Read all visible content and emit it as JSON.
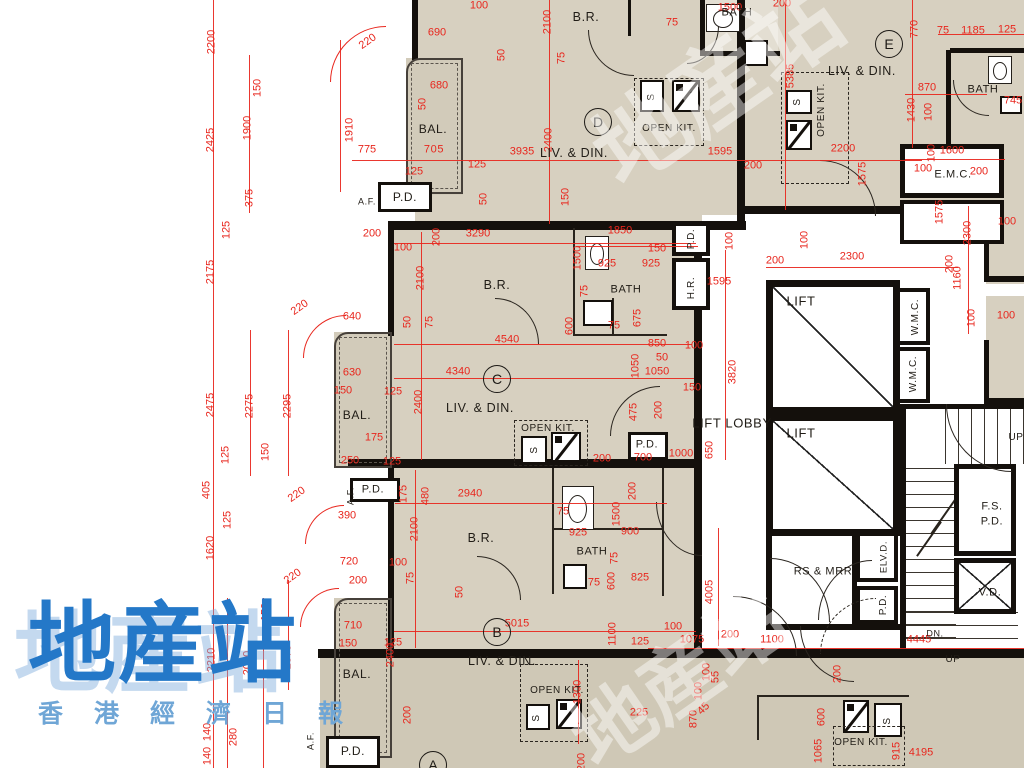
{
  "title": "residential floor plan",
  "colors": {
    "dim_red": "#e8261d",
    "wall": "#14100c",
    "room_fill": "#d7d0c0",
    "balcony_fill": "#d2cbba",
    "watermark_blue": "#2478c8",
    "watermark_sub": "#6fa6d6"
  },
  "watermark": {
    "main": "地産站",
    "sub": "香港經濟日報",
    "faint": "地産站"
  },
  "unit_circles": [
    {
      "t": "D",
      "x": 598,
      "y": 122
    },
    {
      "t": "E",
      "x": 889,
      "y": 44
    },
    {
      "t": "C",
      "x": 497,
      "y": 379
    },
    {
      "t": "B",
      "x": 497,
      "y": 632
    },
    {
      "t": "A",
      "x": 433,
      "y": 765
    }
  ],
  "room_labels": [
    {
      "t": "B.R.",
      "x": 586,
      "y": 17
    },
    {
      "t": "BATH",
      "x": 737,
      "y": 13,
      "s": 11
    },
    {
      "t": "BAL.",
      "x": 433,
      "y": 129,
      "s": 12
    },
    {
      "t": "705",
      "x": 434,
      "y": 150,
      "s": 11,
      "red": 1
    },
    {
      "t": "LIV. & DIN.",
      "x": 574,
      "y": 153
    },
    {
      "t": "OPEN KIT.",
      "x": 669,
      "y": 129,
      "s": 10
    },
    {
      "t": "P.D.",
      "x": 405,
      "y": 197,
      "s": 12
    },
    {
      "t": "A.F.",
      "x": 367,
      "y": 202,
      "s": 9
    },
    {
      "t": "LIV. & DIN.",
      "x": 862,
      "y": 71
    },
    {
      "t": "OPEN KIT.",
      "x": 822,
      "y": 110,
      "s": 10,
      "v": 1
    },
    {
      "t": "BATH",
      "x": 983,
      "y": 90,
      "s": 11
    },
    {
      "t": "E.M.C.",
      "x": 953,
      "y": 175,
      "s": 11
    },
    {
      "t": "B.R.",
      "x": 497,
      "y": 285
    },
    {
      "t": "BATH",
      "x": 626,
      "y": 290,
      "s": 11
    },
    {
      "t": "LIV. & DIN.",
      "x": 480,
      "y": 408
    },
    {
      "t": "OPEN KIT.",
      "x": 548,
      "y": 429,
      "s": 10
    },
    {
      "t": "BAL.",
      "x": 357,
      "y": 415,
      "s": 12
    },
    {
      "t": "P.D.",
      "x": 692,
      "y": 239,
      "s": 10,
      "v": 1
    },
    {
      "t": "H.R.",
      "x": 692,
      "y": 288,
      "s": 10,
      "v": 1
    },
    {
      "t": "P.D.",
      "x": 373,
      "y": 490,
      "s": 11
    },
    {
      "t": "A.F.",
      "x": 351,
      "y": 496,
      "s": 9,
      "v": 1
    },
    {
      "t": "LIFT",
      "x": 801,
      "y": 301,
      "s": 13
    },
    {
      "t": "LIFT",
      "x": 801,
      "y": 433,
      "s": 13
    },
    {
      "t": "LIFT LOBBY",
      "x": 732,
      "y": 423,
      "s": 13
    },
    {
      "t": "W.M.C.",
      "x": 916,
      "y": 317,
      "s": 10,
      "v": 1
    },
    {
      "t": "W.M.C.",
      "x": 914,
      "y": 374,
      "s": 10,
      "v": 1
    },
    {
      "t": "P.D.",
      "x": 647,
      "y": 445,
      "s": 11
    },
    {
      "t": "B.R.",
      "x": 481,
      "y": 538
    },
    {
      "t": "BATH",
      "x": 592,
      "y": 552,
      "s": 11
    },
    {
      "t": "LIV. & DIN.",
      "x": 502,
      "y": 661
    },
    {
      "t": "OPEN KIT.",
      "x": 557,
      "y": 691,
      "s": 10
    },
    {
      "t": "BAL.",
      "x": 357,
      "y": 674,
      "s": 12
    },
    {
      "t": "P.D.",
      "x": 353,
      "y": 751,
      "s": 12
    },
    {
      "t": "A.F.",
      "x": 311,
      "y": 741,
      "s": 9,
      "v": 1
    },
    {
      "t": "RS & MRR",
      "x": 823,
      "y": 572,
      "s": 11
    },
    {
      "t": "ELV.D.",
      "x": 884,
      "y": 557,
      "s": 9.5,
      "v": 1
    },
    {
      "t": "P.D.",
      "x": 884,
      "y": 605,
      "s": 10,
      "v": 1
    },
    {
      "t": "F.S.",
      "x": 992,
      "y": 507,
      "s": 11
    },
    {
      "t": "P.D.",
      "x": 992,
      "y": 522,
      "s": 11
    },
    {
      "t": "V.D.",
      "x": 990,
      "y": 593,
      "s": 11
    },
    {
      "t": "DN.",
      "x": 935,
      "y": 634,
      "s": 9
    },
    {
      "t": "UP",
      "x": 953,
      "y": 660,
      "s": 10
    },
    {
      "t": "UP",
      "x": 1016,
      "y": 438,
      "s": 10
    },
    {
      "t": "OPEN KIT.",
      "x": 861,
      "y": 743,
      "s": 10
    },
    {
      "t": "S",
      "x": 652,
      "y": 97,
      "s": 10,
      "v": 1
    },
    {
      "t": "S",
      "x": 798,
      "y": 102,
      "s": 10,
      "v": 1
    },
    {
      "t": "S",
      "x": 535,
      "y": 450,
      "s": 10,
      "v": 1
    },
    {
      "t": "S",
      "x": 537,
      "y": 718,
      "s": 10,
      "v": 1
    },
    {
      "t": "S",
      "x": 888,
      "y": 721,
      "s": 10,
      "v": 1
    }
  ],
  "dim_labels": [
    {
      "t": "2200",
      "x": 212,
      "y": 42,
      "v": 1
    },
    {
      "t": "150",
      "x": 258,
      "y": 88,
      "v": 1
    },
    {
      "t": "2425",
      "x": 211,
      "y": 140,
      "v": 1
    },
    {
      "t": "1900",
      "x": 248,
      "y": 128,
      "v": 1
    },
    {
      "t": "375",
      "x": 250,
      "y": 198,
      "v": 1
    },
    {
      "t": "125",
      "x": 227,
      "y": 230,
      "v": 1
    },
    {
      "t": "2175",
      "x": 211,
      "y": 272,
      "v": 1
    },
    {
      "t": "2475",
      "x": 211,
      "y": 405,
      "v": 1
    },
    {
      "t": "2275",
      "x": 250,
      "y": 406,
      "v": 1
    },
    {
      "t": "2295",
      "x": 288,
      "y": 406,
      "v": 1
    },
    {
      "t": "150",
      "x": 266,
      "y": 452,
      "v": 1
    },
    {
      "t": "125",
      "x": 226,
      "y": 455,
      "v": 1
    },
    {
      "t": "405",
      "x": 207,
      "y": 490,
      "v": 1
    },
    {
      "t": "125",
      "x": 228,
      "y": 520,
      "v": 1
    },
    {
      "t": "1620",
      "x": 211,
      "y": 548,
      "v": 1
    },
    {
      "t": "150",
      "x": 266,
      "y": 612,
      "v": 1
    },
    {
      "t": "2210",
      "x": 212,
      "y": 660,
      "v": 1
    },
    {
      "t": "2060",
      "x": 248,
      "y": 663,
      "v": 1
    },
    {
      "t": "2070",
      "x": 288,
      "y": 657,
      "v": 1
    },
    {
      "t": "140",
      "x": 208,
      "y": 732,
      "v": 1
    },
    {
      "t": "280",
      "x": 234,
      "y": 737,
      "v": 1
    },
    {
      "t": "140",
      "x": 208,
      "y": 756,
      "v": 1
    },
    {
      "t": "220",
      "x": 368,
      "y": 42,
      "r": -35
    },
    {
      "t": "690",
      "x": 437,
      "y": 33
    },
    {
      "t": "100",
      "x": 479,
      "y": 6
    },
    {
      "t": "2100",
      "x": 548,
      "y": 22,
      "v": 1
    },
    {
      "t": "680",
      "x": 439,
      "y": 86
    },
    {
      "t": "50",
      "x": 423,
      "y": 104,
      "v": 1
    },
    {
      "t": "775",
      "x": 367,
      "y": 150
    },
    {
      "t": "1910",
      "x": 350,
      "y": 130,
      "v": 1
    },
    {
      "t": "125",
      "x": 414,
      "y": 172
    },
    {
      "t": "125",
      "x": 477,
      "y": 165
    },
    {
      "t": "50",
      "x": 484,
      "y": 199,
      "v": 1
    },
    {
      "t": "50",
      "x": 502,
      "y": 55,
      "v": 1
    },
    {
      "t": "75",
      "x": 562,
      "y": 58,
      "v": 1
    },
    {
      "t": "3935",
      "x": 522,
      "y": 152
    },
    {
      "t": "2400",
      "x": 549,
      "y": 140,
      "v": 1
    },
    {
      "t": "75",
      "x": 672,
      "y": 23
    },
    {
      "t": "1500",
      "x": 730,
      "y": 8
    },
    {
      "t": "1595",
      "x": 720,
      "y": 152
    },
    {
      "t": "200",
      "x": 753,
      "y": 166
    },
    {
      "t": "150",
      "x": 566,
      "y": 197,
      "v": 1
    },
    {
      "t": "200",
      "x": 782,
      "y": 4
    },
    {
      "t": "5385",
      "x": 791,
      "y": 76,
      "v": 1
    },
    {
      "t": "770",
      "x": 915,
      "y": 29,
      "v": 1
    },
    {
      "t": "75",
      "x": 943,
      "y": 31
    },
    {
      "t": "1185",
      "x": 973,
      "y": 31
    },
    {
      "t": "125",
      "x": 1007,
      "y": 30
    },
    {
      "t": "870",
      "x": 927,
      "y": 88
    },
    {
      "t": "1430",
      "x": 912,
      "y": 110,
      "v": 1
    },
    {
      "t": "100",
      "x": 929,
      "y": 112,
      "v": 1
    },
    {
      "t": "745",
      "x": 1013,
      "y": 101
    },
    {
      "t": "1600",
      "x": 952,
      "y": 151
    },
    {
      "t": "100",
      "x": 932,
      "y": 153,
      "v": 1
    },
    {
      "t": "100",
      "x": 923,
      "y": 169
    },
    {
      "t": "200",
      "x": 979,
      "y": 172
    },
    {
      "t": "1575",
      "x": 940,
      "y": 212,
      "v": 1
    },
    {
      "t": "2200",
      "x": 843,
      "y": 149
    },
    {
      "t": "1575",
      "x": 863,
      "y": 174,
      "v": 1
    },
    {
      "t": "2300",
      "x": 968,
      "y": 233,
      "v": 1
    },
    {
      "t": "200",
      "x": 950,
      "y": 264,
      "v": 1
    },
    {
      "t": "1160",
      "x": 958,
      "y": 278,
      "v": 1
    },
    {
      "t": "100",
      "x": 972,
      "y": 318,
      "v": 1
    },
    {
      "t": "100",
      "x": 1006,
      "y": 316
    },
    {
      "t": "100",
      "x": 1007,
      "y": 222
    },
    {
      "t": "200",
      "x": 372,
      "y": 234
    },
    {
      "t": "100",
      "x": 403,
      "y": 248
    },
    {
      "t": "200",
      "x": 437,
      "y": 237,
      "v": 1
    },
    {
      "t": "3290",
      "x": 478,
      "y": 234
    },
    {
      "t": "2100",
      "x": 421,
      "y": 278,
      "v": 1
    },
    {
      "t": "50",
      "x": 408,
      "y": 322,
      "v": 1
    },
    {
      "t": "75",
      "x": 430,
      "y": 322,
      "v": 1
    },
    {
      "t": "220",
      "x": 300,
      "y": 308,
      "r": -35
    },
    {
      "t": "640",
      "x": 352,
      "y": 317
    },
    {
      "t": "630",
      "x": 352,
      "y": 373
    },
    {
      "t": "150",
      "x": 343,
      "y": 391
    },
    {
      "t": "125",
      "x": 393,
      "y": 392
    },
    {
      "t": "4340",
      "x": 458,
      "y": 372
    },
    {
      "t": "4540",
      "x": 507,
      "y": 340
    },
    {
      "t": "2400",
      "x": 419,
      "y": 402,
      "v": 1
    },
    {
      "t": "175",
      "x": 374,
      "y": 438
    },
    {
      "t": "250",
      "x": 350,
      "y": 461
    },
    {
      "t": "125",
      "x": 392,
      "y": 462
    },
    {
      "t": "220",
      "x": 297,
      "y": 495,
      "r": -35
    },
    {
      "t": "390",
      "x": 347,
      "y": 516
    },
    {
      "t": "220",
      "x": 293,
      "y": 577,
      "r": -35
    },
    {
      "t": "1850",
      "x": 620,
      "y": 231
    },
    {
      "t": "150",
      "x": 657,
      "y": 249
    },
    {
      "t": "925",
      "x": 607,
      "y": 264
    },
    {
      "t": "925",
      "x": 651,
      "y": 264
    },
    {
      "t": "1500",
      "x": 578,
      "y": 258,
      "v": 1
    },
    {
      "t": "75",
      "x": 585,
      "y": 291,
      "v": 1
    },
    {
      "t": "600",
      "x": 570,
      "y": 326,
      "v": 1
    },
    {
      "t": "75",
      "x": 614,
      "y": 326
    },
    {
      "t": "675",
      "x": 638,
      "y": 318,
      "v": 1
    },
    {
      "t": "850",
      "x": 657,
      "y": 344
    },
    {
      "t": "100",
      "x": 694,
      "y": 346
    },
    {
      "t": "50",
      "x": 662,
      "y": 358
    },
    {
      "t": "1050",
      "x": 657,
      "y": 372
    },
    {
      "t": "1050",
      "x": 636,
      "y": 366,
      "v": 1
    },
    {
      "t": "150",
      "x": 692,
      "y": 388
    },
    {
      "t": "475",
      "x": 634,
      "y": 412,
      "v": 1
    },
    {
      "t": "200",
      "x": 659,
      "y": 410,
      "v": 1
    },
    {
      "t": "1595",
      "x": 719,
      "y": 282
    },
    {
      "t": "200",
      "x": 775,
      "y": 261
    },
    {
      "t": "100",
      "x": 730,
      "y": 241,
      "v": 1
    },
    {
      "t": "3820",
      "x": 733,
      "y": 372,
      "v": 1
    },
    {
      "t": "2300",
      "x": 852,
      "y": 257
    },
    {
      "t": "100",
      "x": 805,
      "y": 240,
      "v": 1
    },
    {
      "t": "650",
      "x": 710,
      "y": 450,
      "v": 1
    },
    {
      "t": "700",
      "x": 643,
      "y": 458
    },
    {
      "t": "1000",
      "x": 681,
      "y": 454
    },
    {
      "t": "200",
      "x": 602,
      "y": 459
    },
    {
      "t": "175",
      "x": 404,
      "y": 494,
      "v": 1
    },
    {
      "t": "480",
      "x": 426,
      "y": 496,
      "v": 1
    },
    {
      "t": "2940",
      "x": 470,
      "y": 494
    },
    {
      "t": "75",
      "x": 563,
      "y": 512
    },
    {
      "t": "925",
      "x": 578,
      "y": 533
    },
    {
      "t": "900",
      "x": 630,
      "y": 532
    },
    {
      "t": "1500",
      "x": 617,
      "y": 514,
      "v": 1
    },
    {
      "t": "200",
      "x": 633,
      "y": 491,
      "v": 1
    },
    {
      "t": "2100",
      "x": 415,
      "y": 529,
      "v": 1
    },
    {
      "t": "100",
      "x": 398,
      "y": 563
    },
    {
      "t": "720",
      "x": 349,
      "y": 562
    },
    {
      "t": "200",
      "x": 358,
      "y": 581
    },
    {
      "t": "75",
      "x": 411,
      "y": 578,
      "v": 1
    },
    {
      "t": "50",
      "x": 460,
      "y": 592,
      "v": 1
    },
    {
      "t": "75",
      "x": 615,
      "y": 558,
      "v": 1
    },
    {
      "t": "75",
      "x": 594,
      "y": 583
    },
    {
      "t": "600",
      "x": 612,
      "y": 581,
      "v": 1
    },
    {
      "t": "825",
      "x": 640,
      "y": 578
    },
    {
      "t": "710",
      "x": 353,
      "y": 626
    },
    {
      "t": "150",
      "x": 348,
      "y": 644
    },
    {
      "t": "125",
      "x": 393,
      "y": 643
    },
    {
      "t": "5015",
      "x": 517,
      "y": 624
    },
    {
      "t": "2400",
      "x": 391,
      "y": 655,
      "v": 1
    },
    {
      "t": "200",
      "x": 408,
      "y": 715,
      "v": 1
    },
    {
      "t": "1300",
      "x": 578,
      "y": 692,
      "v": 1
    },
    {
      "t": "225",
      "x": 639,
      "y": 713
    },
    {
      "t": "1100",
      "x": 613,
      "y": 634,
      "v": 1
    },
    {
      "t": "125",
      "x": 640,
      "y": 642
    },
    {
      "t": "100",
      "x": 673,
      "y": 627
    },
    {
      "t": "1075",
      "x": 692,
      "y": 640
    },
    {
      "t": "200",
      "x": 730,
      "y": 635
    },
    {
      "t": "1100",
      "x": 772,
      "y": 640
    },
    {
      "t": "4005",
      "x": 710,
      "y": 592,
      "v": 1
    },
    {
      "t": "4445",
      "x": 919,
      "y": 640
    },
    {
      "t": "100",
      "x": 707,
      "y": 672,
      "v": 1
    },
    {
      "t": "55",
      "x": 716,
      "y": 677,
      "v": 1
    },
    {
      "t": "45",
      "x": 704,
      "y": 709,
      "r": -45
    },
    {
      "t": "100",
      "x": 699,
      "y": 691,
      "v": 1
    },
    {
      "t": "870",
      "x": 694,
      "y": 719,
      "v": 1
    },
    {
      "t": "200",
      "x": 838,
      "y": 674,
      "v": 1
    },
    {
      "t": "600",
      "x": 822,
      "y": 717,
      "v": 1
    },
    {
      "t": "1065",
      "x": 819,
      "y": 751,
      "v": 1
    },
    {
      "t": "915",
      "x": 897,
      "y": 751,
      "v": 1
    },
    {
      "t": "4195",
      "x": 921,
      "y": 753
    },
    {
      "t": "200",
      "x": 582,
      "y": 762,
      "v": 1
    }
  ]
}
